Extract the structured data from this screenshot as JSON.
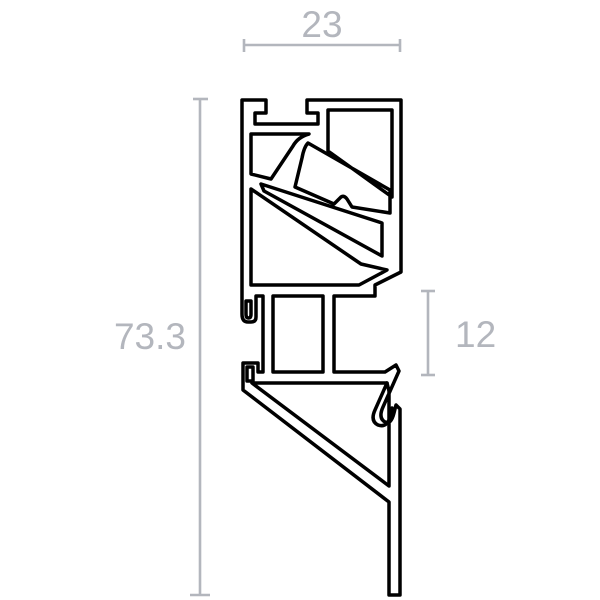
{
  "drawing": {
    "title": "Aluminium extrusion profile cross-section",
    "kind": "technical-dimension-drawing"
  },
  "colors": {
    "ink": "#000000",
    "dimension": "#b3b6bd",
    "background": "#ffffff"
  },
  "dimensions": {
    "width": {
      "label": "23"
    },
    "height": {
      "label": "73.3"
    },
    "right_gap": {
      "label": "12"
    }
  }
}
